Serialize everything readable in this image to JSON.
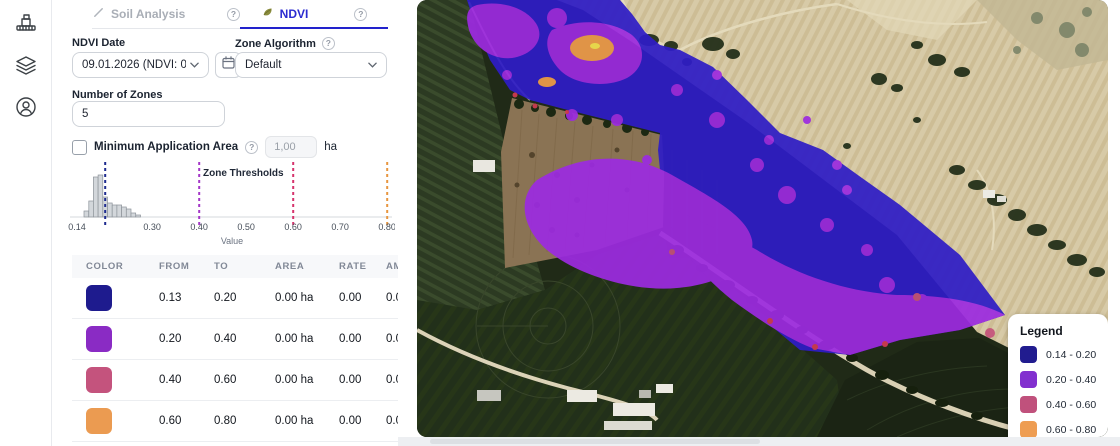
{
  "app": {
    "accent": "#2b2bd0"
  },
  "sidebar": {
    "items": [
      {
        "icon": "harvester-icon"
      },
      {
        "icon": "layers-icon"
      },
      {
        "icon": "account-icon"
      }
    ]
  },
  "panel": {
    "tabs": [
      {
        "label": "Soil Analysis",
        "active": false
      },
      {
        "label": "NDVI",
        "active": true
      }
    ],
    "ndvi_date": {
      "label": "NDVI Date",
      "value": "09.01.2026 (NDVI: 0.194"
    },
    "zone_algorithm": {
      "label": "Zone Algorithm",
      "value": "Default"
    },
    "number_of_zones": {
      "label": "Number of Zones",
      "value": "5"
    },
    "minimum_application_area": {
      "label": "Minimum Application Area",
      "value": "1,00",
      "unit": "ha",
      "checked": false
    },
    "table": {
      "headers": [
        "COLOR",
        "FROM",
        "TO",
        "AREA",
        "RATE",
        "AMOUNT"
      ],
      "rows": [
        {
          "color": "#1e1b8e",
          "from": "0.13",
          "to": "0.20",
          "area": "0.00 ha",
          "rate": "0.00",
          "amount": "0.00"
        },
        {
          "color": "#8a2bc4",
          "from": "0.20",
          "to": "0.40",
          "area": "0.00 ha",
          "rate": "0.00",
          "amount": "0.00"
        },
        {
          "color": "#c4537d",
          "from": "0.40",
          "to": "0.60",
          "area": "0.00 ha",
          "rate": "0.00",
          "amount": "0.00"
        },
        {
          "color": "#eb9b51",
          "from": "0.60",
          "to": "0.80",
          "area": "0.00 ha",
          "rate": "0.00",
          "amount": "0.00"
        }
      ]
    }
  },
  "chart_data": {
    "type": "bar",
    "title": "Zone Thresholds",
    "xlabel": "Value",
    "xlim": [
      0.14,
      0.8
    ],
    "ticks": [
      0.14,
      0.3,
      0.4,
      0.5,
      0.6,
      0.7,
      0.8
    ],
    "bin_start": 0.155,
    "bin_width": 0.01,
    "counts": [
      3,
      8,
      20,
      21,
      10,
      7,
      6,
      6,
      5,
      4,
      2,
      1
    ],
    "grid": false,
    "thresholds": [
      {
        "value": 0.2,
        "color": "#1e2b8f"
      },
      {
        "value": 0.4,
        "color": "#a437c8"
      },
      {
        "value": 0.6,
        "color": "#d6336c"
      },
      {
        "value": 0.8,
        "color": "#e8963f"
      }
    ]
  },
  "map": {
    "zone_fill_low": "#2f1dc6",
    "zone_fill_mid": "#9c2be0",
    "legend": {
      "title": "Legend",
      "items": [
        {
          "color": "#211c8f",
          "label": "0.14 - 0.20"
        },
        {
          "color": "#8230cf",
          "label": "0.20 - 0.40"
        },
        {
          "color": "#c0517c",
          "label": "0.40 - 0.60"
        },
        {
          "color": "#ee9d52",
          "label": "0.60 - 0.80"
        }
      ]
    }
  }
}
